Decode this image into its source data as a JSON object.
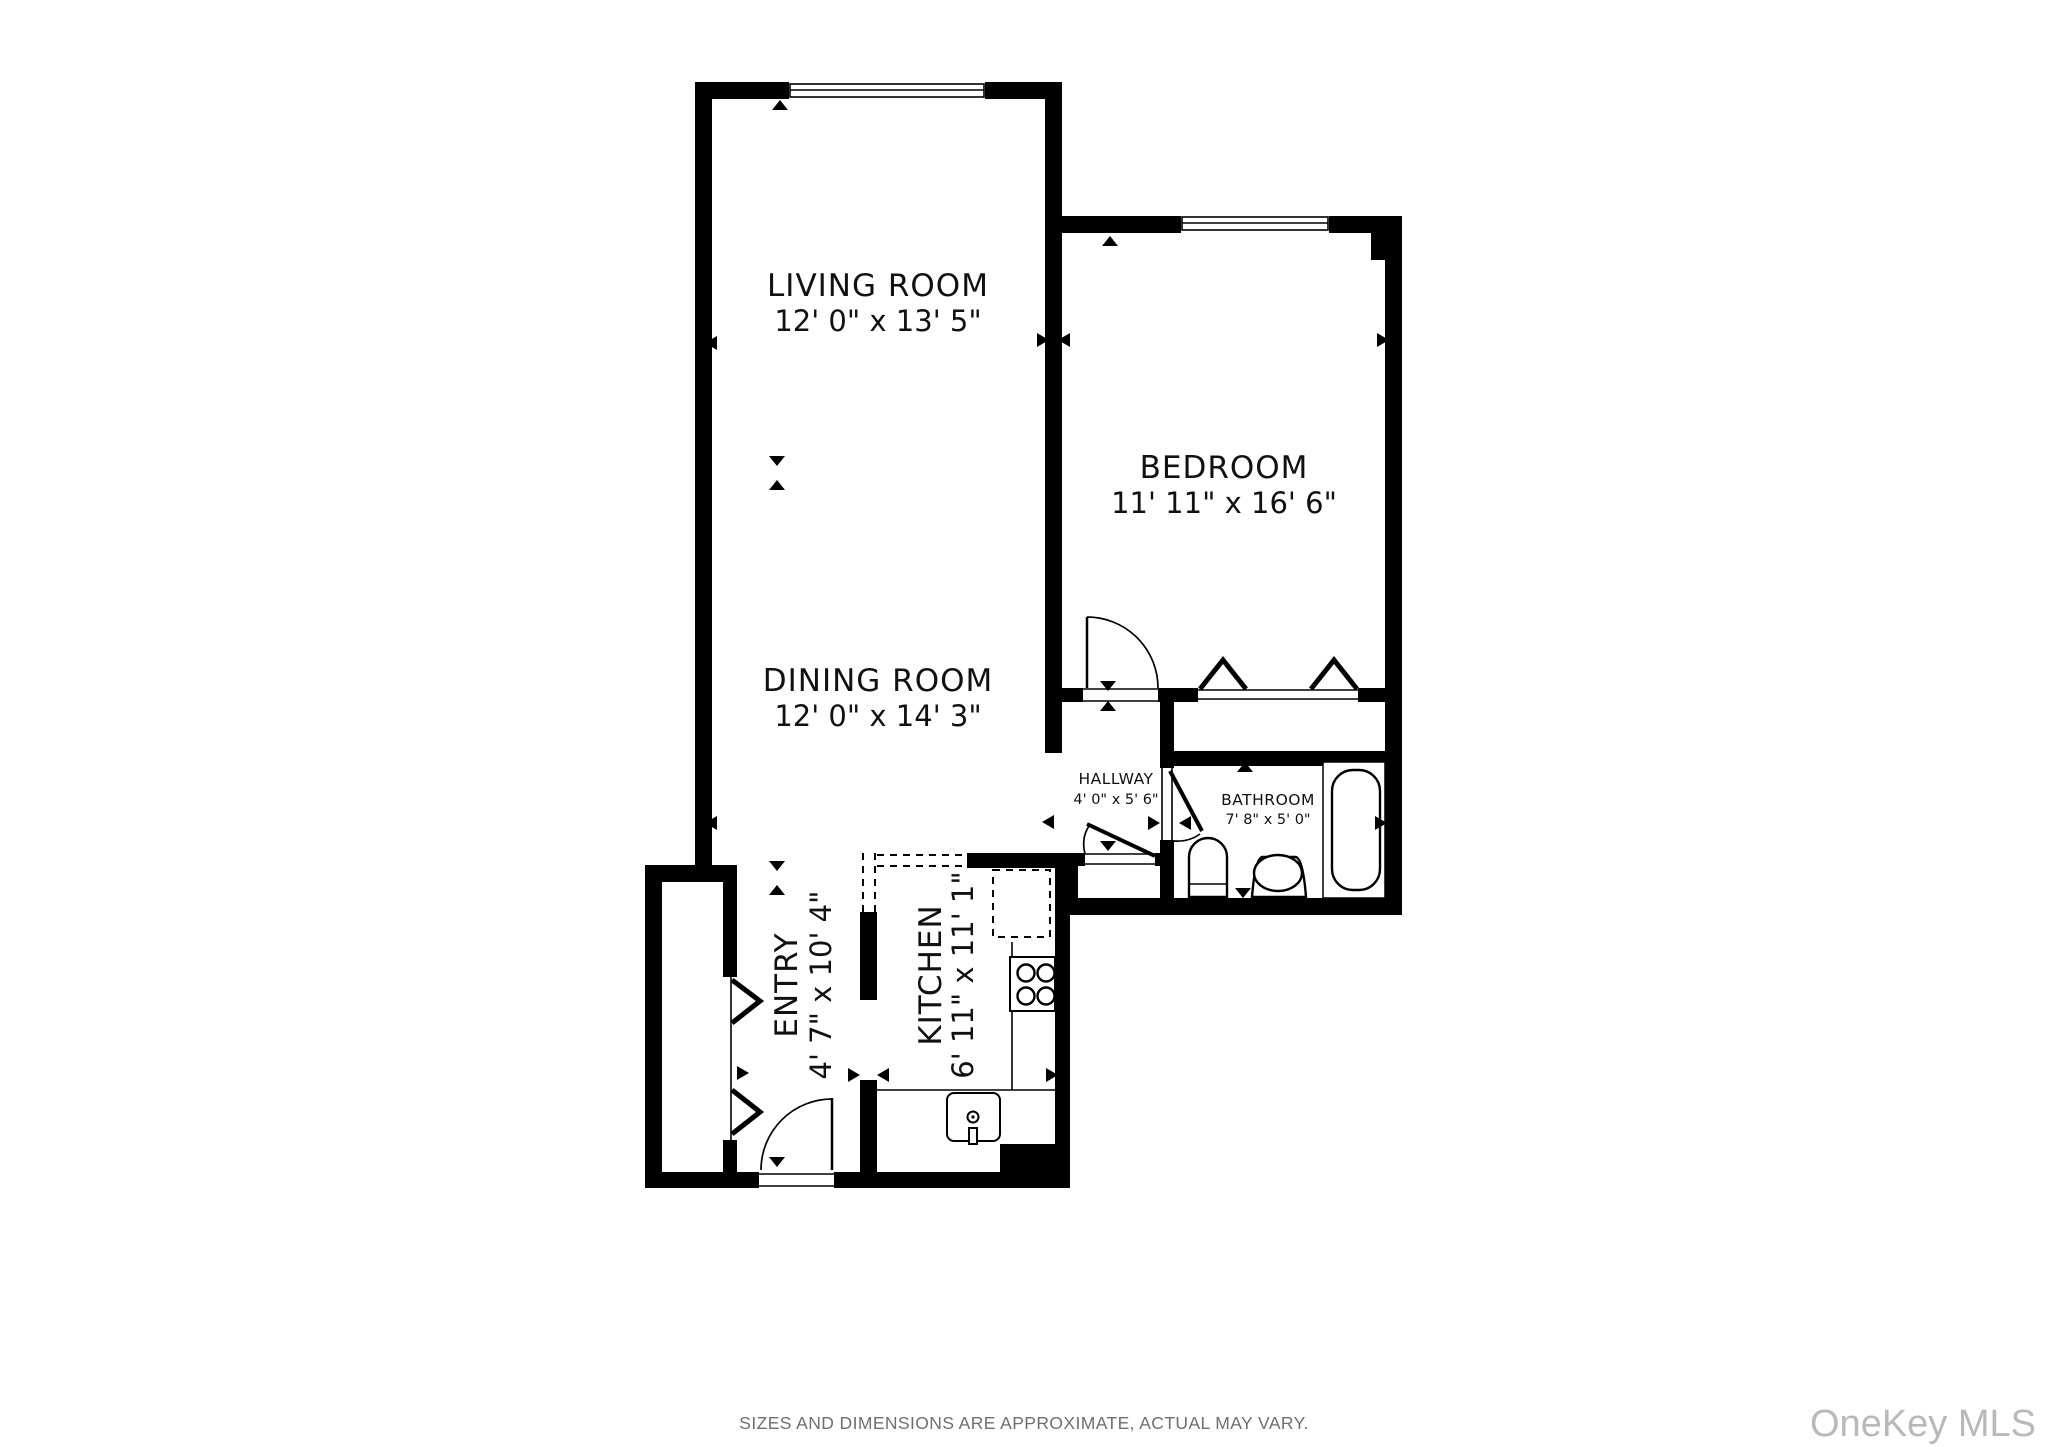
{
  "plan": {
    "rooms": [
      {
        "id": "living-room",
        "name": "LIVING ROOM",
        "dims": "12' 0\" x 13' 5\""
      },
      {
        "id": "bedroom",
        "name": "BEDROOM",
        "dims": "11' 11\" x 16' 6\""
      },
      {
        "id": "dining-room",
        "name": "DINING ROOM",
        "dims": "12' 0\" x 14' 3\""
      },
      {
        "id": "hallway",
        "name": "HALLWAY",
        "dims": "4' 0\" x 5' 6\""
      },
      {
        "id": "bathroom",
        "name": "BATHROOM",
        "dims": "7' 8\" x 5' 0\""
      },
      {
        "id": "entry",
        "name": "ENTRY",
        "dims": "4' 7\" x 10' 4\""
      },
      {
        "id": "kitchen",
        "name": "KITCHEN",
        "dims": "6' 11\" x 11' 1\""
      }
    ],
    "fixtures": [
      "bathtub",
      "toilet",
      "bathroom-sink",
      "stove-burners",
      "kitchen-sink",
      "upper-cabinets-dashed",
      "bifold-closet-doors",
      "door-swings",
      "windows"
    ],
    "colors": {
      "walls": "#000000",
      "background": "#ffffff",
      "label_text": "#111111",
      "disclaimer_text": "#6f6f6f",
      "watermark_text": "#b9b9b9"
    }
  },
  "footer": {
    "disclaimer": "SIZES AND DIMENSIONS ARE APPROXIMATE, ACTUAL MAY VARY."
  },
  "watermark": {
    "text": "OneKey MLS"
  }
}
